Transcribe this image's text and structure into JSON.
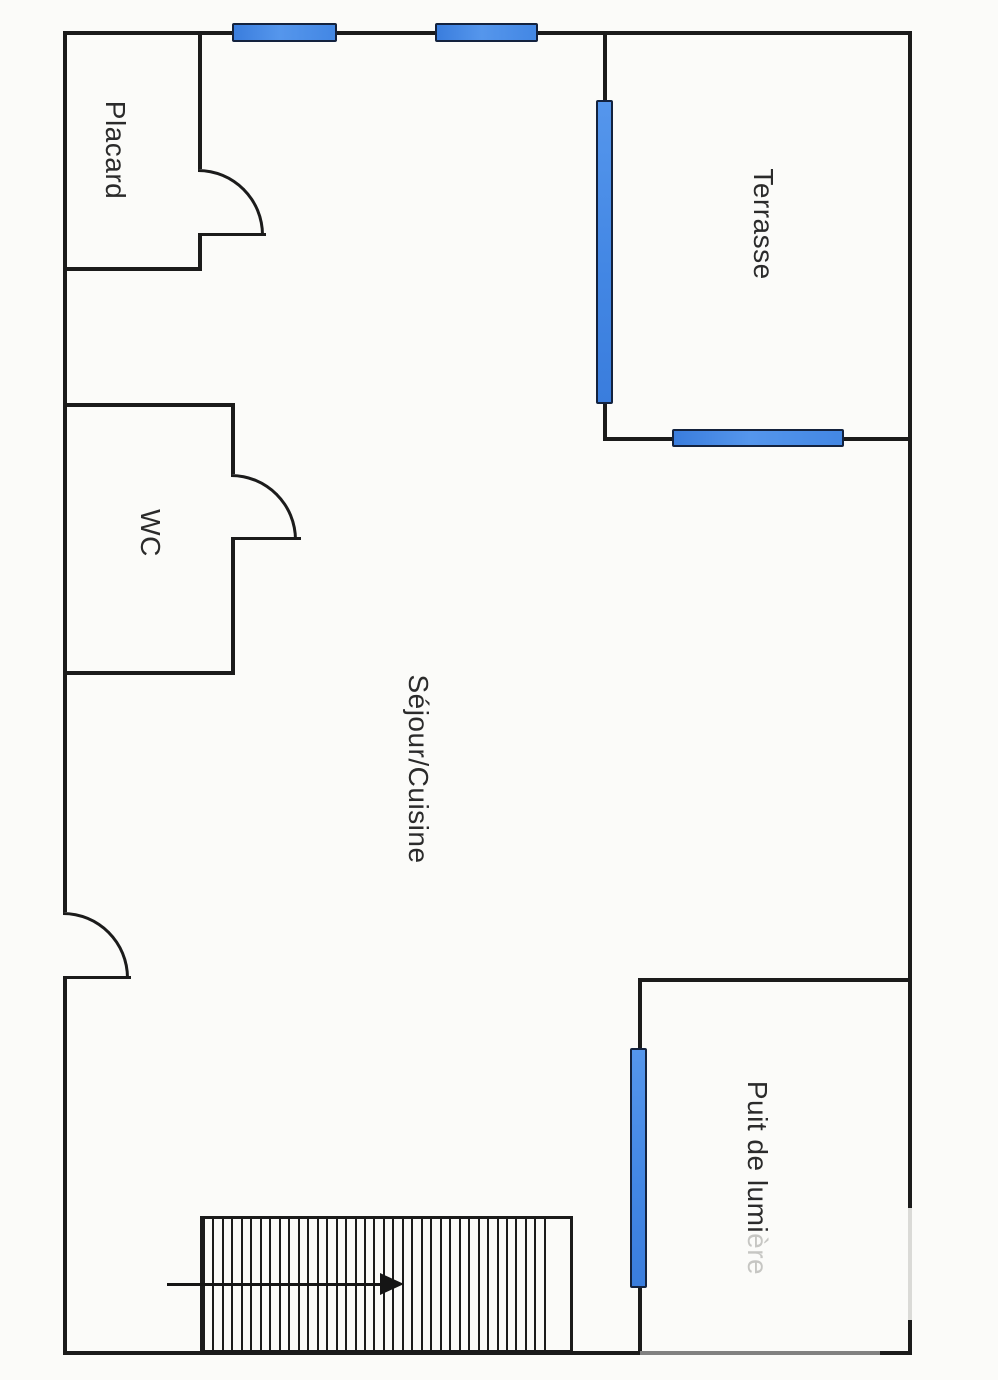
{
  "plan": {
    "type": "floor-plan",
    "rooms": [
      {
        "id": "placard",
        "label": "Placard"
      },
      {
        "id": "wc",
        "label": "WC"
      },
      {
        "id": "sejour",
        "label": "Séjour/Cuisine"
      },
      {
        "id": "terrasse",
        "label": "Terrasse"
      },
      {
        "id": "puit",
        "label": "Puit de lumière",
        "label_main": "Puit de lumi",
        "label_faded": "ère"
      }
    ],
    "stairs": {
      "tread_lines": 37,
      "arrow_direction": "right"
    },
    "doors": [
      {
        "room": "placard",
        "swing": "quarter-arc"
      },
      {
        "room": "wc",
        "swing": "quarter-arc"
      },
      {
        "room": "entrance",
        "swing": "quarter-arc"
      }
    ],
    "windows": [
      {
        "id": "top-window-1",
        "orientation": "horizontal"
      },
      {
        "id": "top-window-2",
        "orientation": "horizontal"
      },
      {
        "id": "terrasse-left",
        "orientation": "vertical"
      },
      {
        "id": "terrasse-bottom",
        "orientation": "horizontal"
      },
      {
        "id": "puit-left",
        "orientation": "vertical"
      }
    ]
  },
  "colors": {
    "wall": "#1b1b1b",
    "window_fill": "#4a8ce8",
    "window_border": "#13223e",
    "background": "#fbfbf9",
    "label": "#2b2b2b",
    "label_faded": "#c6c6c3",
    "faded_wall": "#dadad7"
  }
}
